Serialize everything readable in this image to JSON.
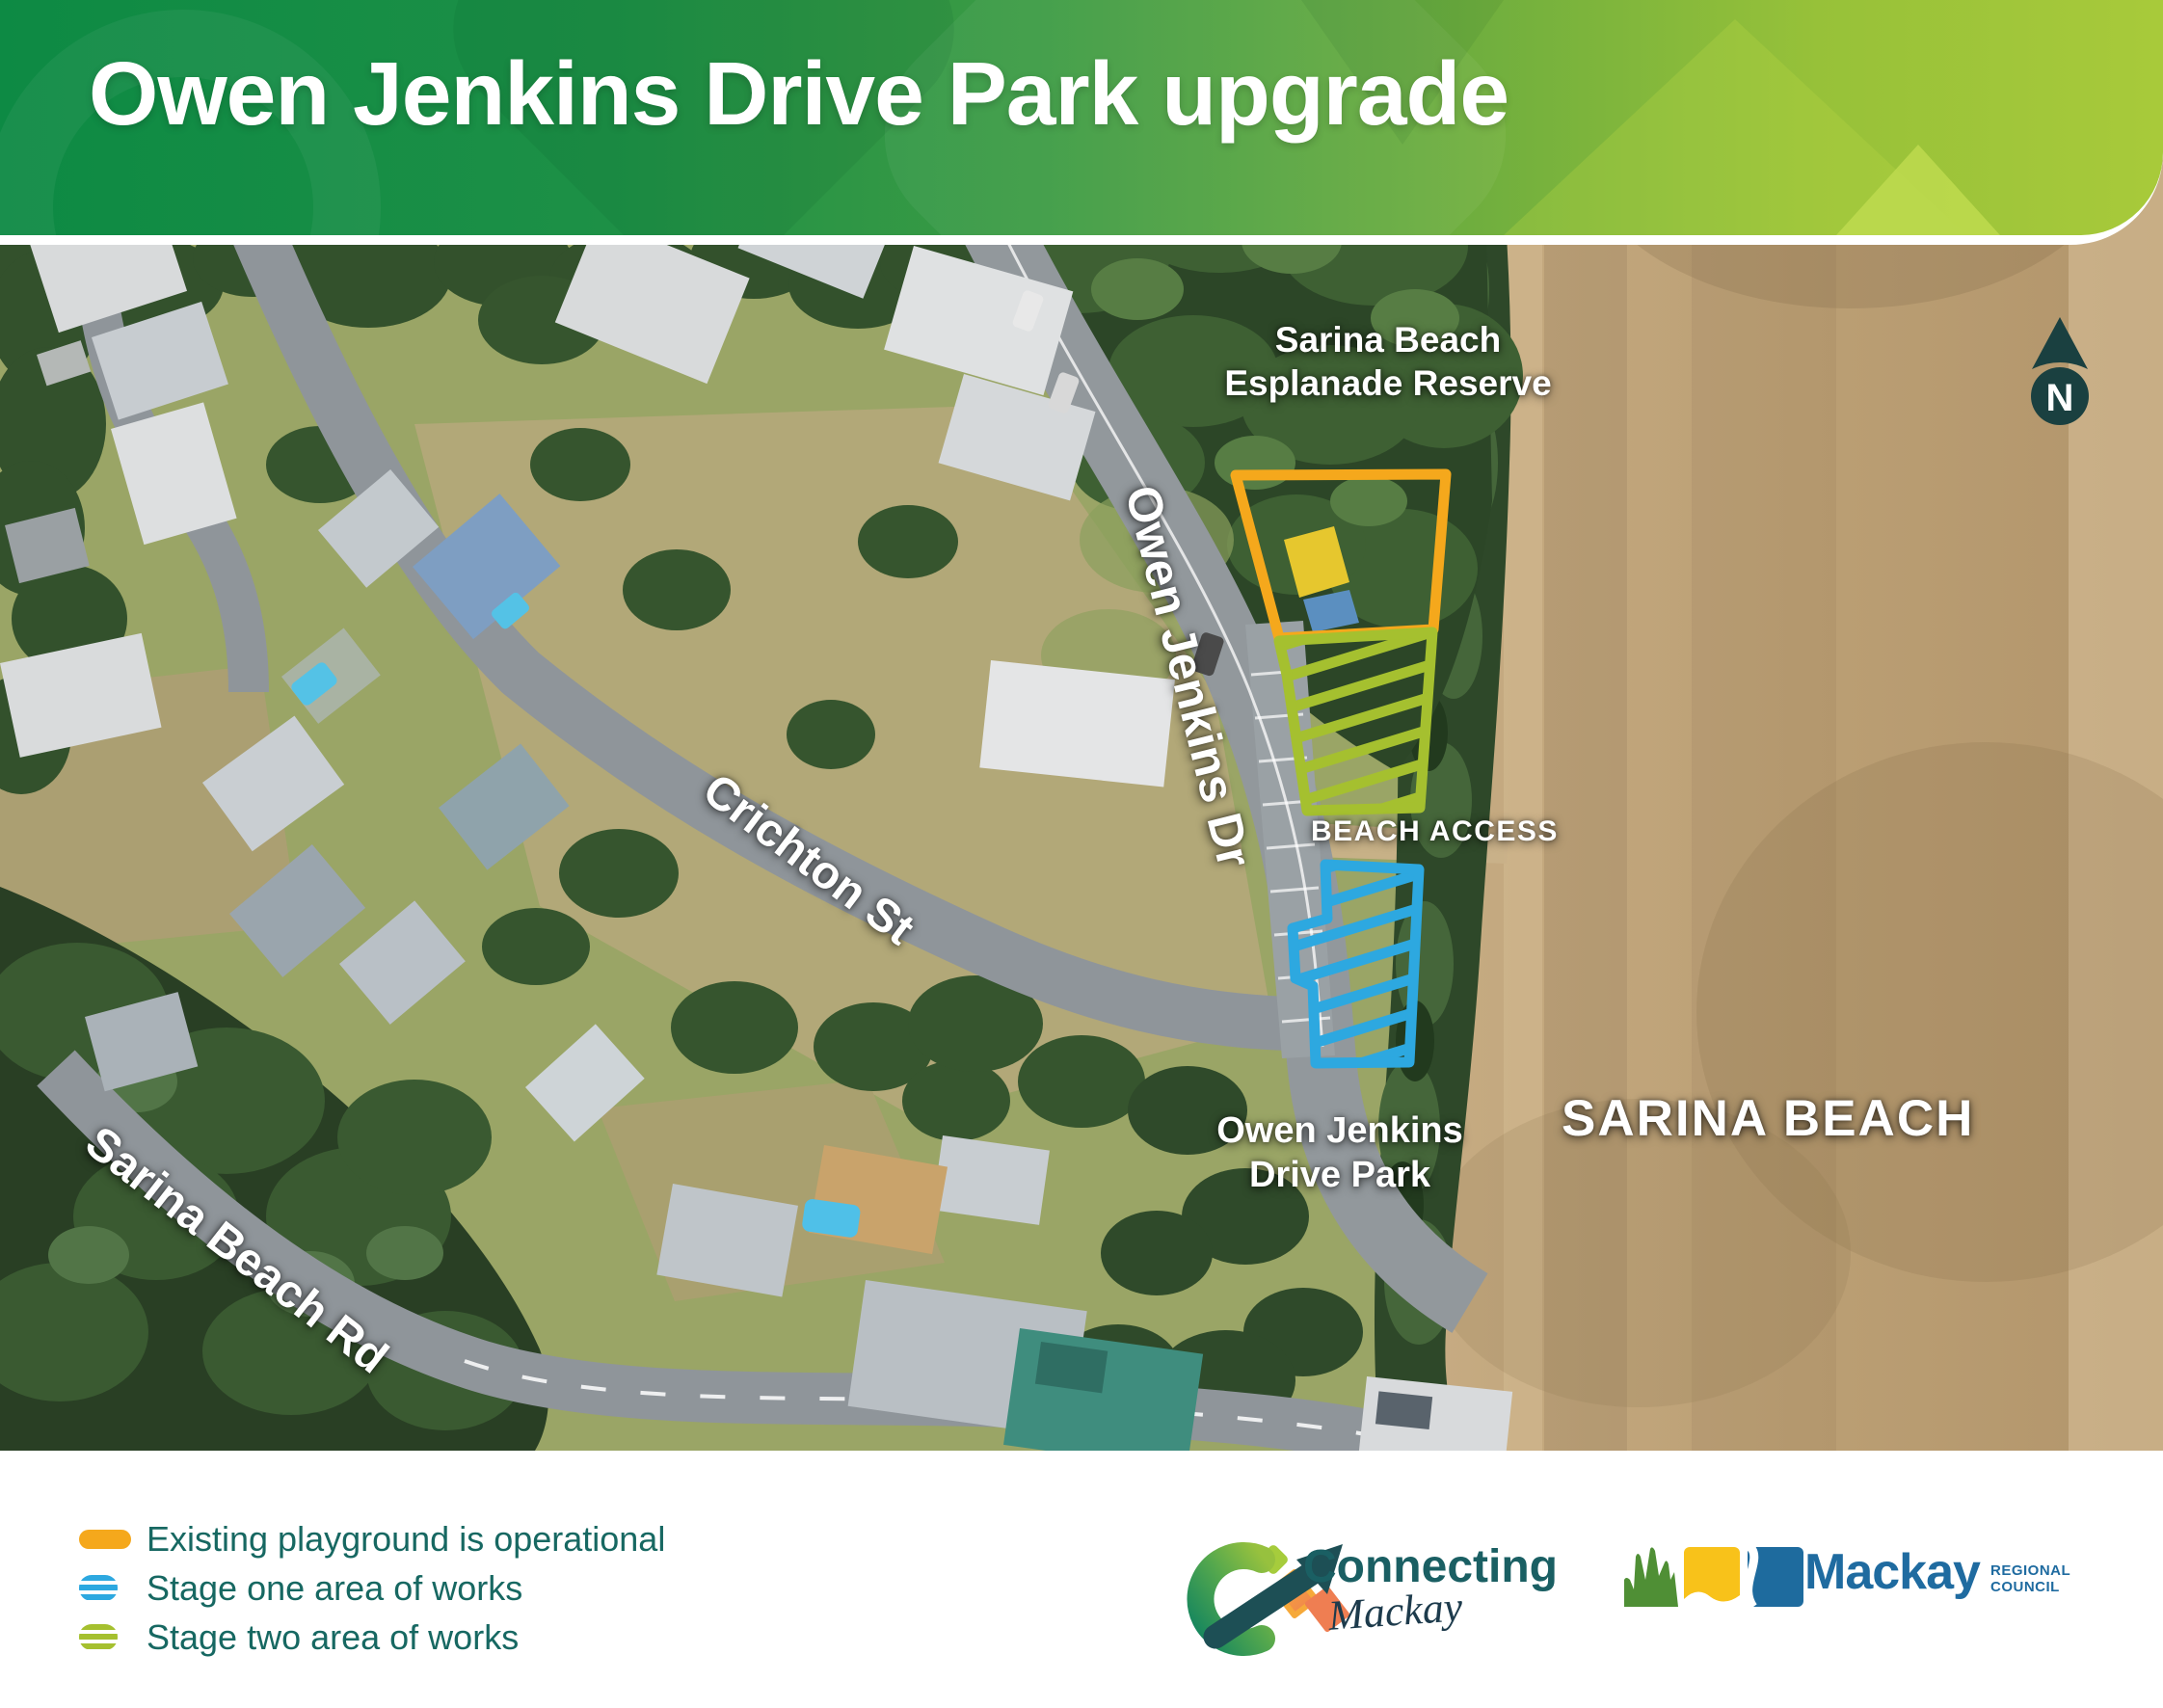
{
  "header": {
    "title": "Owen Jenkins Drive Park upgrade"
  },
  "map": {
    "labels": {
      "reserve_line1": "Sarina Beach",
      "reserve_line2": "Esplanade Reserve",
      "owen_jenkins_dr": "Owen Jenkins Dr",
      "crichton_st": "Crichton St",
      "sarina_beach_rd": "Sarina Beach Rd",
      "beach_access": "BEACH ACCESS",
      "park_line1": "Owen Jenkins",
      "park_line2": "Drive Park",
      "beach_name": "SARINA BEACH",
      "north": "N"
    },
    "colors": {
      "existing": "#f5a81c",
      "stage_one": "#2da8e0",
      "stage_two": "#a5c02f",
      "legend_text": "#176862"
    }
  },
  "legend": {
    "items": [
      {
        "label": "Existing playground is operational",
        "key": "existing",
        "style": "solid"
      },
      {
        "label": "Stage one area of works",
        "key": "stage_one",
        "style": "hatched"
      },
      {
        "label": "Stage two area of works",
        "key": "stage_two",
        "style": "hatched"
      }
    ]
  },
  "logos": {
    "connecting": {
      "line1": "Connecting",
      "line2": "Mackay"
    },
    "council": {
      "name": "Mackay",
      "sub_line1": "REGIONAL",
      "sub_line2": "COUNCIL"
    }
  }
}
